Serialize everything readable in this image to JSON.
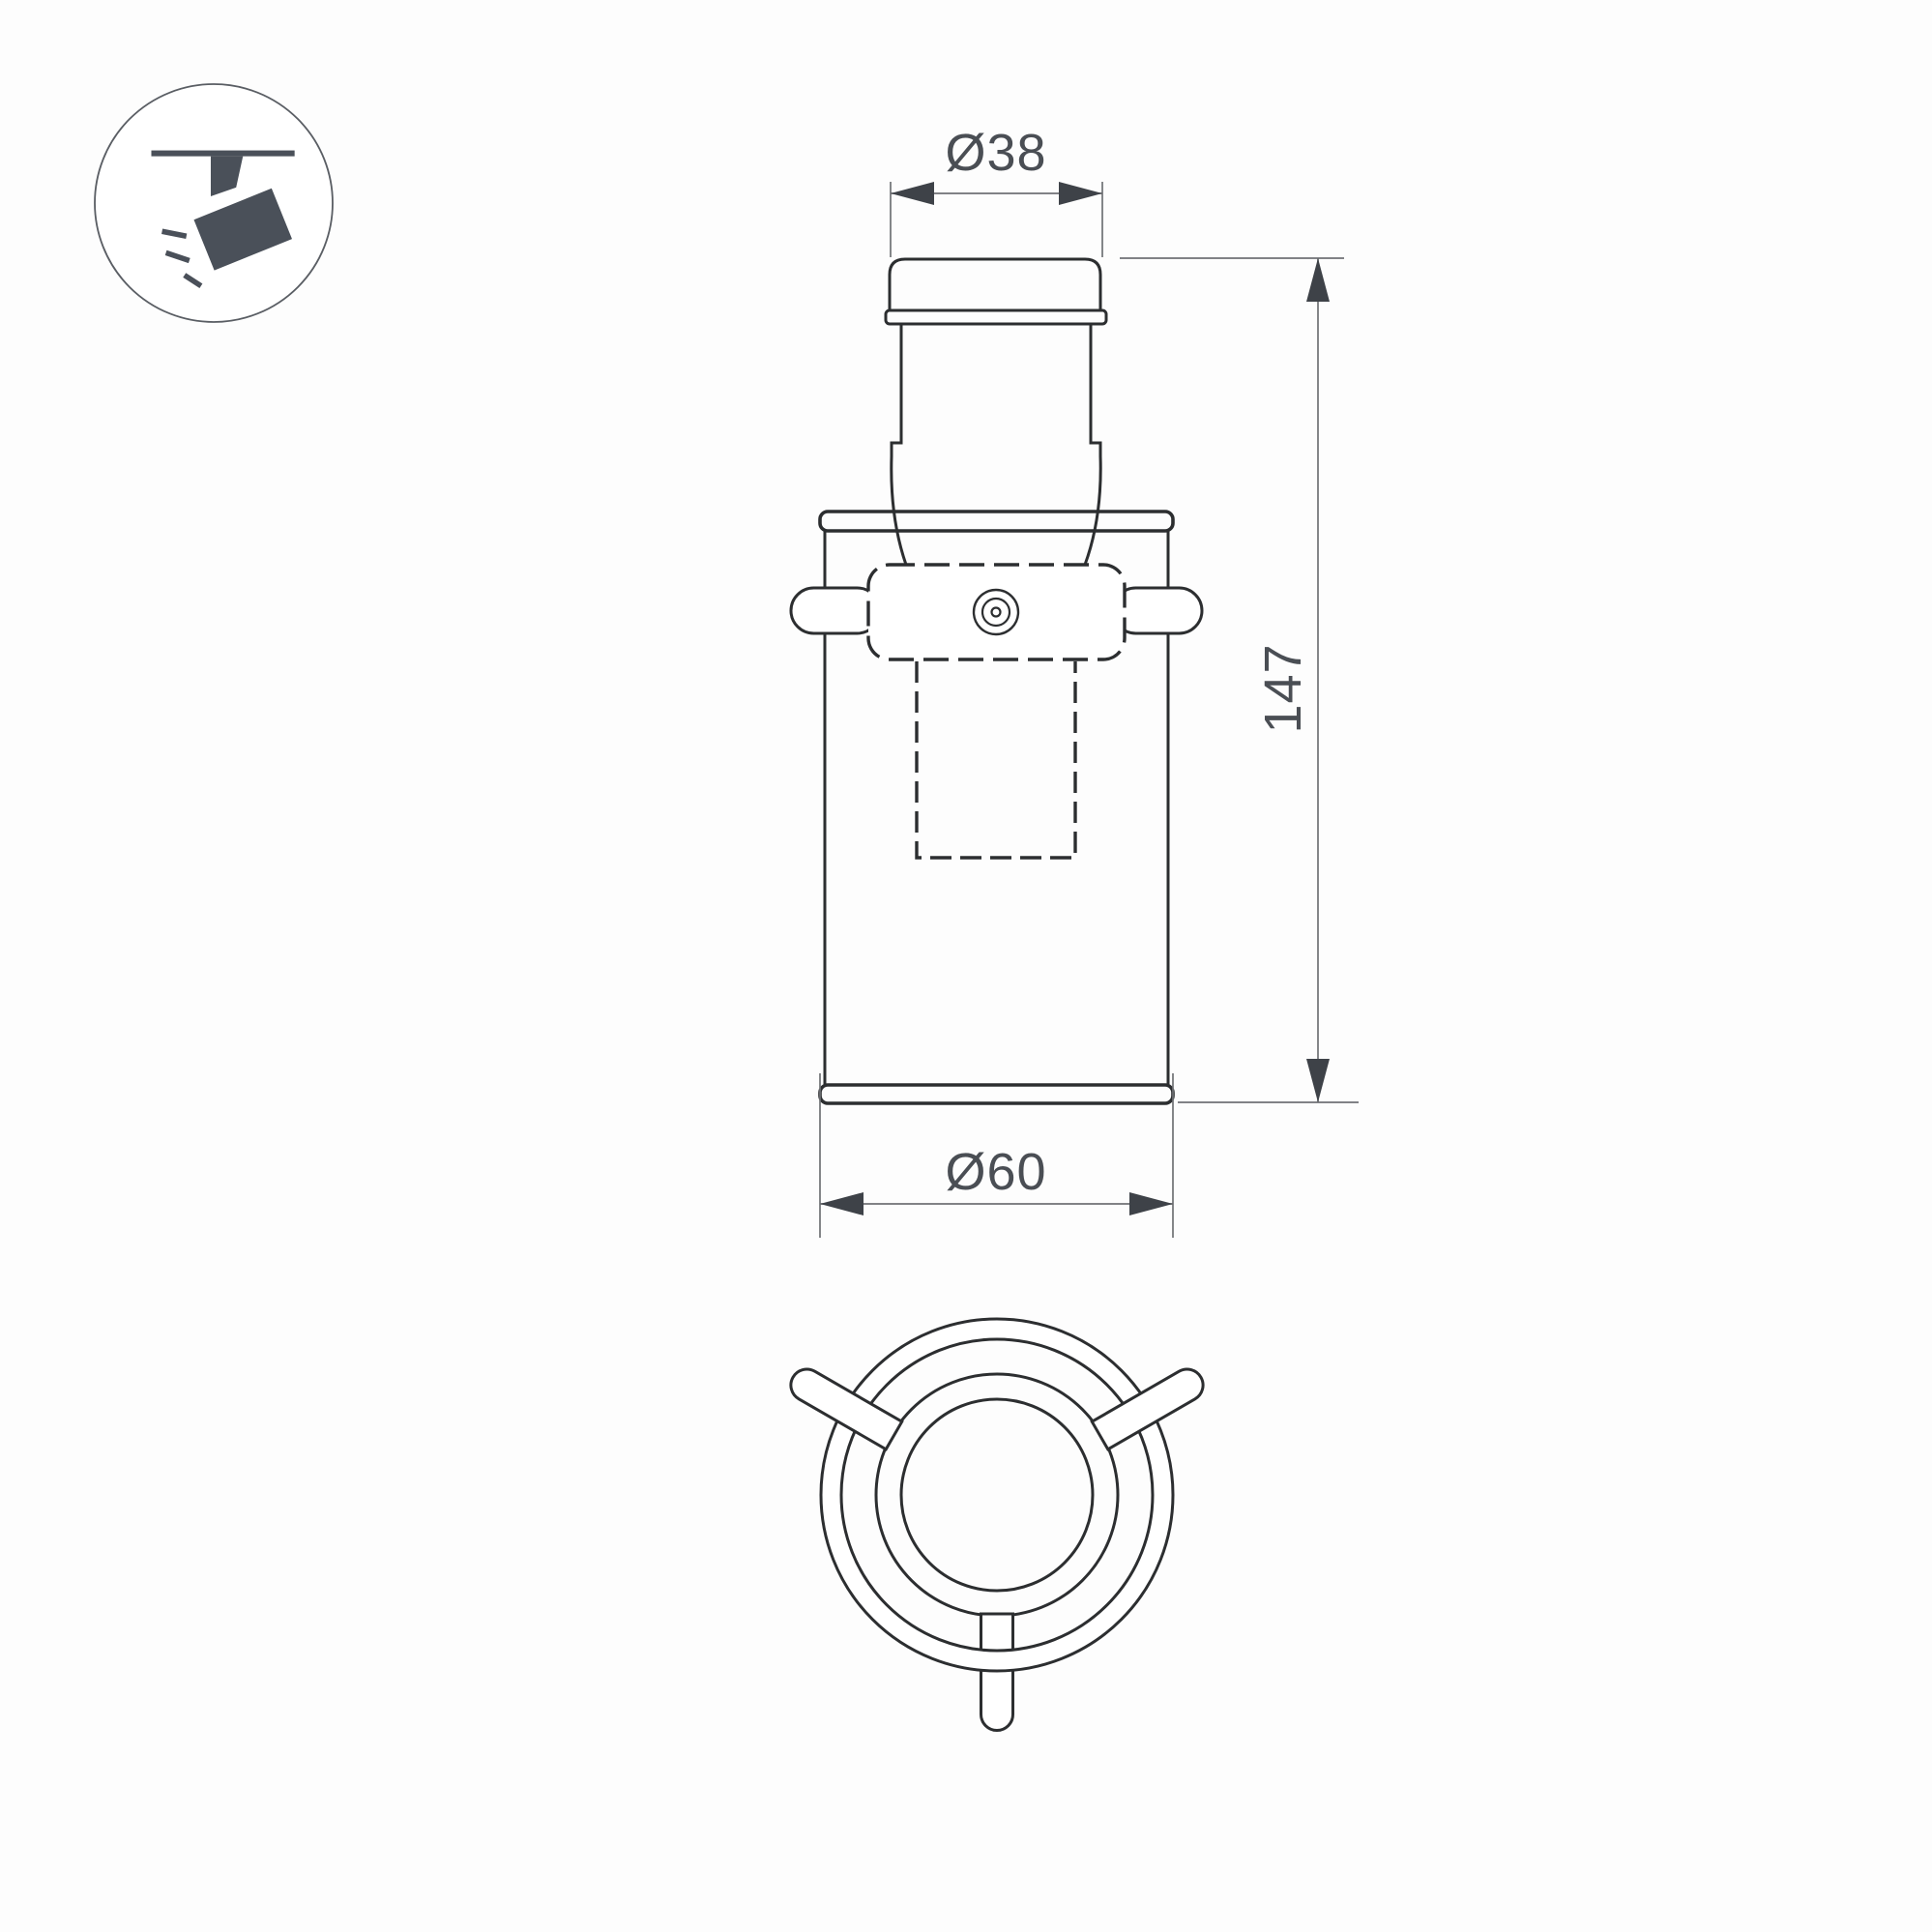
{
  "theme": {
    "background": "#fdfdfd",
    "line_color": "#2c2e30",
    "dim_line_color": "#6f7174",
    "dim_arrow_color": "#3e4248",
    "dim_text_color": "#4a4e54",
    "icon_color": "#4a5059",
    "icon_ring_color": "#5a5e64"
  },
  "drawing": {
    "dimensions": {
      "top_diameter": "Ø38",
      "height": "147",
      "body_diameter": "Ø60"
    }
  }
}
